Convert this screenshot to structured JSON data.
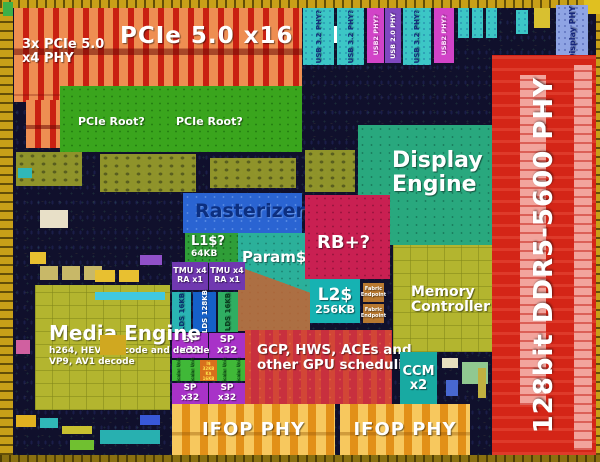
{
  "regions": {
    "pcie_x4_phy": {
      "line1": "3x PCIe 5.0",
      "line2": "x4 PHY"
    },
    "pcie_x16_phy": {
      "label": "PCIe 5.0 x16 PHY"
    },
    "pcie_root": {
      "label": "PCIe Root?"
    },
    "usb32_phy": {
      "label": "USB 3.2 PHY?"
    },
    "usb2_phy": {
      "label": "USB2 PHY?"
    },
    "usb20_phy": {
      "label": "USB 2.0 PHY"
    },
    "display_phy": {
      "label": "Display PHY"
    },
    "ddr_phy": {
      "label": "128bit DDR5-5600 PHY"
    },
    "display_engine": {
      "line1": "Display",
      "line2": "Engine"
    },
    "memory_controller": {
      "line1": "Memory",
      "line2": "Controller"
    },
    "rasterizer": {
      "label": "Rasterizer?"
    },
    "l1_cache": {
      "label": "L1$?",
      "size": "64KB"
    },
    "param_cache": {
      "label": "Param$?"
    },
    "rb_plus": {
      "label": "RB+?"
    },
    "l2_cache": {
      "label": "L2$",
      "size": "256KB"
    },
    "fabric_endpoint": {
      "line1": "Fabric",
      "line2": "Endpoint"
    },
    "tmu": {
      "line1": "TMU x4",
      "line2": "RA x1"
    },
    "lds_16": {
      "label": "LDS 16KB"
    },
    "lds_128": {
      "label": "LDS 128KB"
    },
    "sp": {
      "line1": "SP",
      "line2": "x32"
    },
    "scalar_unit": {
      "label": "Scalar Unit"
    },
    "i_cache": {
      "label": "I$ 32KB"
    },
    "k_cache": {
      "label": "K$ 16KB"
    },
    "gcp": {
      "line1": "GCP, HWS, ACEs and",
      "line2": "other GPU scheduling"
    },
    "media_engine": {
      "label": "Media Engine",
      "sub1": "h264, HEVC encode and decode",
      "sub2": "VP9, AV1 decode"
    },
    "ccm": {
      "line1": "CCM",
      "line2": "x2"
    },
    "ifop_phy": {
      "label": "IFOP PHY"
    }
  },
  "colors": {
    "pcie_red": "#c92012",
    "ddr_red": "#d42517",
    "ifop_orange": "#e29018",
    "olive": "#b3b52f",
    "display_teal": "#29a87e",
    "root_green": "#3aa51d",
    "rasterizer_blue": "#2a64d2",
    "rb_crimson": "#c92052",
    "sp_purple": "#a832c8",
    "usb_teal": "#3cc6c6",
    "seal_ring_gold": "#c8a018"
  }
}
